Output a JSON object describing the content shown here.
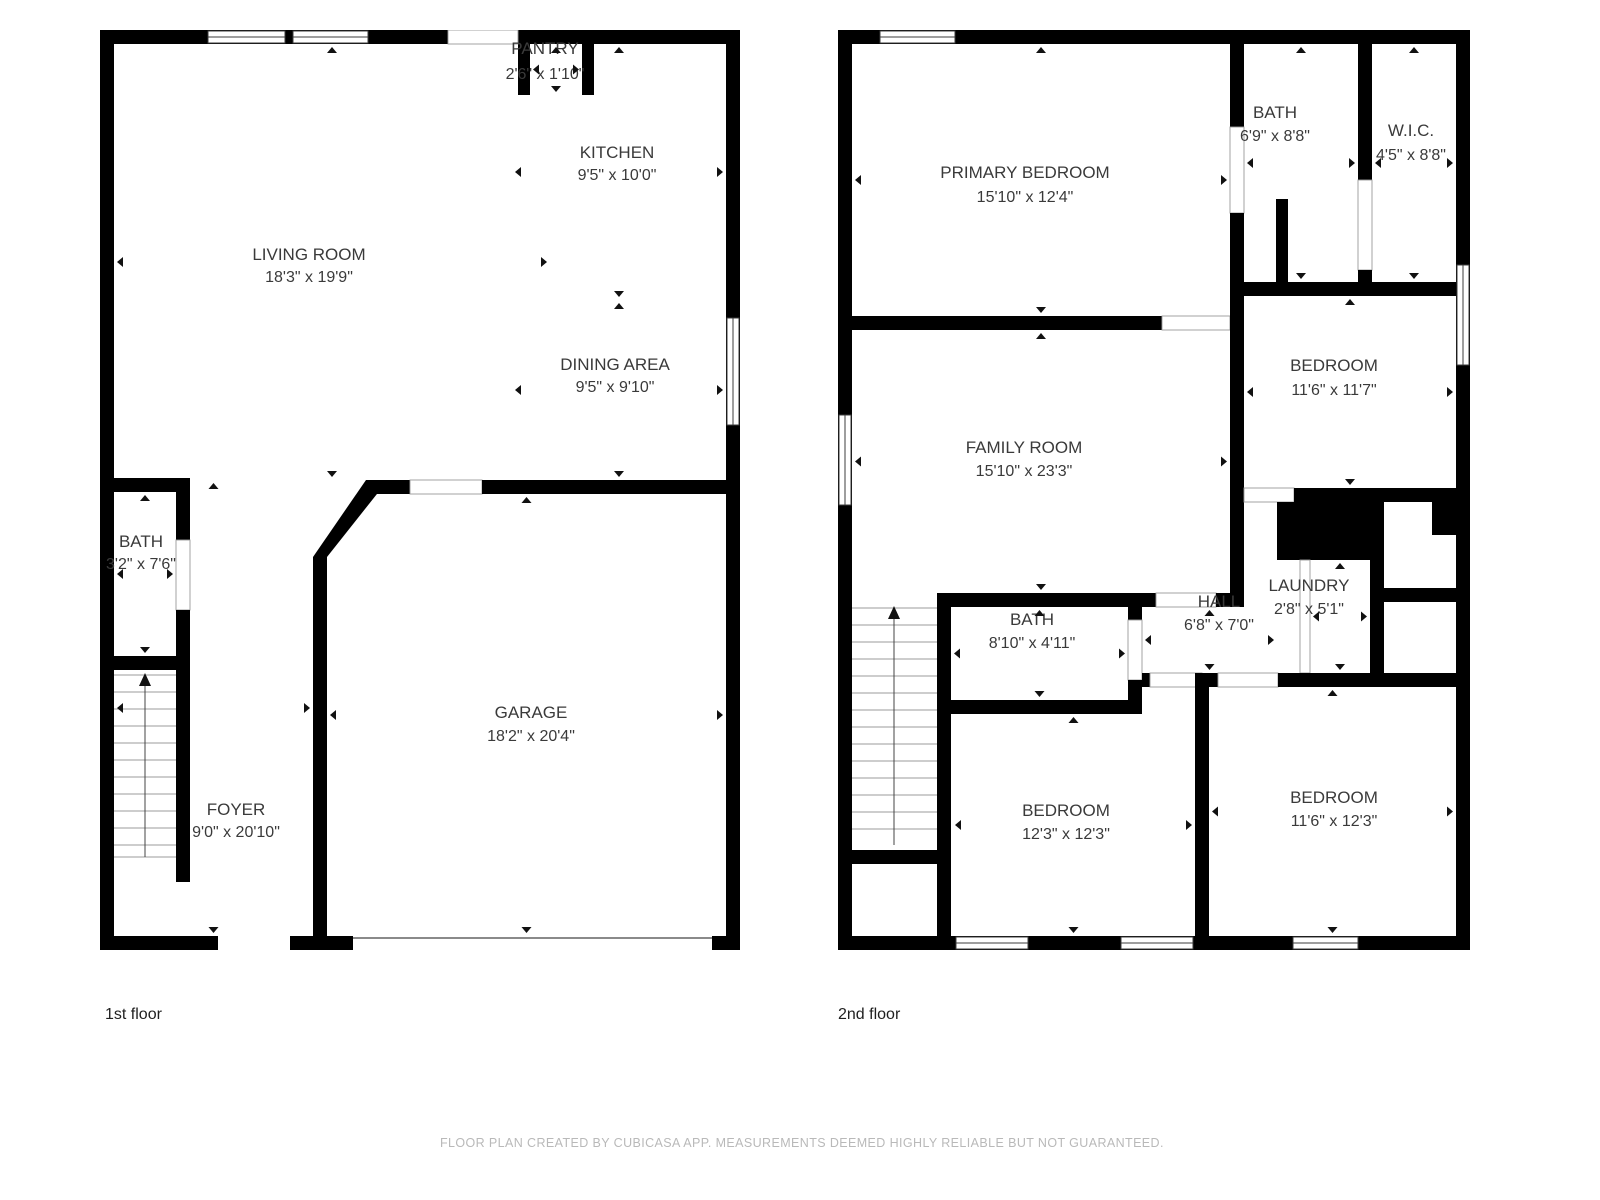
{
  "footer": {
    "text": "FLOOR PLAN CREATED BY CUBICASA APP. MEASUREMENTS DEEMED HIGHLY RELIABLE BUT NOT GUARANTEED."
  },
  "colors": {
    "wall": "#000000",
    "room_text": "#3a3a3a",
    "footer_text": "#b9b9b9",
    "background": "#ffffff"
  },
  "floors": [
    {
      "label": "1st floor",
      "rooms": [
        {
          "name": "PANTRY",
          "dims": "2'6\" x 1'10\"",
          "lx": 445,
          "ny": 24,
          "dy": 49,
          "box": [
            430,
            14,
            52,
            51
          ]
        },
        {
          "name": "KITCHEN",
          "dims": "9'5\" x 10'0\"",
          "lx": 517,
          "ny": 128,
          "dy": 150,
          "box": [
            412,
            14,
            214,
            256
          ]
        },
        {
          "name": "LIVING ROOM",
          "dims": "18'3\" x 19'9\"",
          "lx": 209,
          "ny": 230,
          "dy": 252,
          "box": [
            14,
            14,
            436,
            436
          ]
        },
        {
          "name": "DINING AREA",
          "dims": "9'5\" x 9'10\"",
          "lx": 515,
          "ny": 340,
          "dy": 362,
          "box": [
            412,
            270,
            214,
            180
          ]
        },
        {
          "name": "BATH",
          "dims": "3'2\" x 7'6\"",
          "lx": 41,
          "ny": 517,
          "dy": 539,
          "box": [
            14,
            462,
            62,
            164
          ]
        },
        {
          "name": "GARAGE",
          "dims": "18'2\" x 20'4\"",
          "lx": 431,
          "ny": 688,
          "dy": 711,
          "box": [
            227,
            464,
            399,
            442
          ]
        },
        {
          "name": "FOYER",
          "dims": "9'0\" x 20'10\"",
          "lx": 136,
          "ny": 785,
          "dy": 807,
          "box": [
            14,
            450,
            199,
            456
          ]
        }
      ]
    },
    {
      "label": "2nd floor",
      "rooms": [
        {
          "name": "PRIMARY BEDROOM",
          "dims": "15'10\" x 12'4\"",
          "lx": 187,
          "ny": 148,
          "dy": 172,
          "box": [
            14,
            14,
            378,
            272
          ]
        },
        {
          "name": "BATH",
          "dims": "6'9\" x 8'8\"",
          "lx": 437,
          "ny": 88,
          "dy": 111,
          "box": [
            406,
            14,
            114,
            238
          ]
        },
        {
          "name": "W.I.C.",
          "dims": "4'5\" x 8'8\"",
          "lx": 573,
          "ny": 106,
          "dy": 130,
          "box": [
            534,
            14,
            84,
            238
          ]
        },
        {
          "name": "BEDROOM",
          "dims": "11'6\" x 11'7\"",
          "lx": 496,
          "ny": 341,
          "dy": 365,
          "box": [
            406,
            266,
            212,
            192
          ]
        },
        {
          "name": "FAMILY ROOM",
          "dims": "15'10\" x 23'3\"",
          "lx": 186,
          "ny": 423,
          "dy": 446,
          "box": [
            14,
            300,
            378,
            263
          ]
        },
        {
          "name": "BATH",
          "dims": "8'10\" x 4'11\"",
          "lx": 194,
          "ny": 595,
          "dy": 618,
          "box": [
            113,
            577,
            177,
            93
          ]
        },
        {
          "name": "HALL",
          "dims": "6'8\" x 7'0\"",
          "lx": 381,
          "ny": 577,
          "dy": 600,
          "box": [
            304,
            577,
            135,
            66
          ]
        },
        {
          "name": "LAUNDRY",
          "dims": "2'8\" x 5'1\"",
          "lx": 471,
          "ny": 561,
          "dy": 584,
          "box": [
            472,
            530,
            60,
            113
          ]
        },
        {
          "name": "BEDROOM",
          "dims": "12'3\" x 12'3\"",
          "lx": 228,
          "ny": 786,
          "dy": 809,
          "box": [
            114,
            684,
            243,
            222
          ]
        },
        {
          "name": "BEDROOM",
          "dims": "11'6\" x 12'3\"",
          "lx": 496,
          "ny": 773,
          "dy": 796,
          "box": [
            371,
            657,
            247,
            249
          ]
        }
      ]
    }
  ]
}
